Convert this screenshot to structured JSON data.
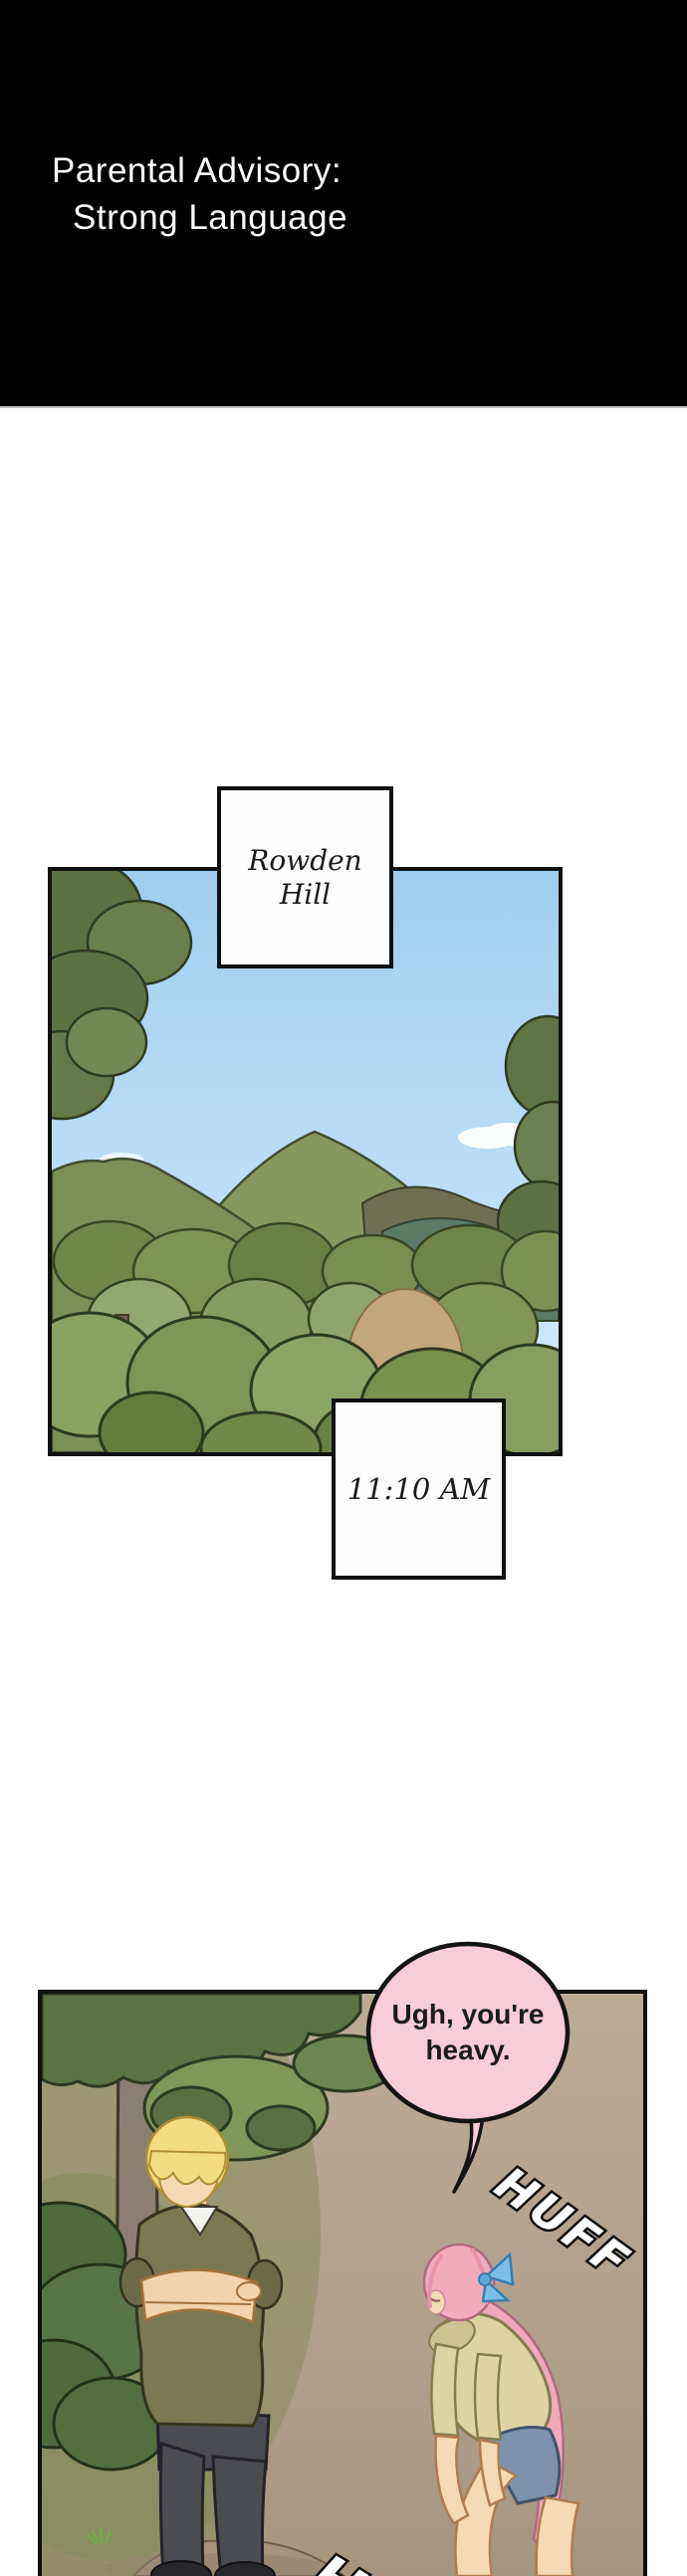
{
  "advisory_banner": {
    "line1": "Parental Advisory:",
    "line2": "Strong Language",
    "background_color": "#000000",
    "text_color": "#ffffff"
  },
  "panel_landscape": {
    "location_caption_line1": "Rowden",
    "location_caption_line2": "Hill",
    "time_caption": "11:10 AM",
    "colors": {
      "sky": "#a8d3f2",
      "hills": "#87985e",
      "foliage": "#7a914f",
      "dirt": "#c3a87d",
      "panel_border": "#101010"
    }
  },
  "panel_characters": {
    "speech_line1": "Ugh, you're",
    "speech_line2": "heavy.",
    "sfx_upper": "HUFF",
    "sfx_lower": "HUFF",
    "colors": {
      "speech_bubble_fill": "#f8ccd9",
      "ground": "#b3a28f",
      "man_sweater": "#7a7951",
      "man_hair": "#f3dc82",
      "woman_hoodie": "#ded3a2",
      "woman_hair": "#f0a9bb",
      "woman_bow": "#7cc0ea",
      "denim_shorts": "#7d92ad"
    }
  }
}
